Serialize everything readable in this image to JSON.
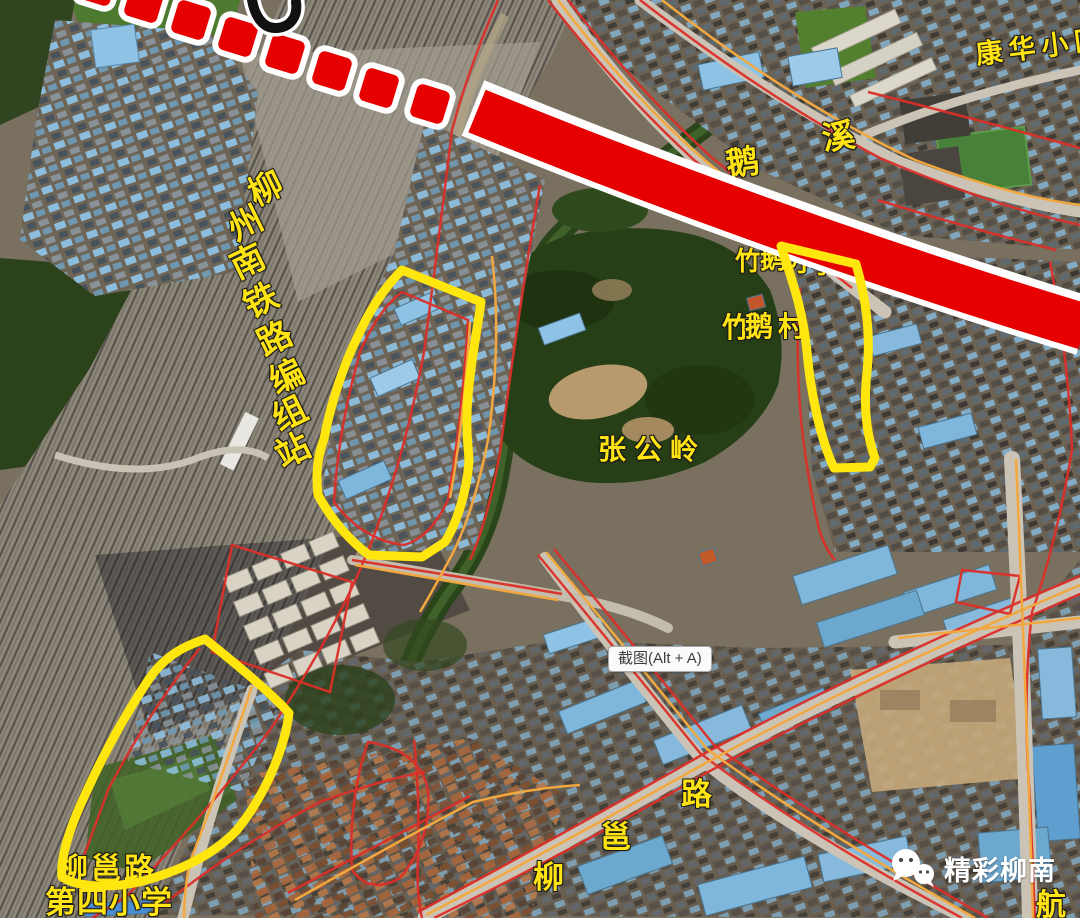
{
  "map": {
    "annotations": {
      "metro_line_color": "#e60000",
      "highlight_color": "#ffe60f",
      "road_line_red": "#dc2f28",
      "road_line_orange": "#f2a83e"
    },
    "labels": {
      "rail_yard": {
        "text": "柳州南铁路编组站",
        "chars": [
          "柳",
          "州",
          "南",
          "铁",
          "路",
          "编",
          "组",
          "站"
        ]
      },
      "goose_creek": {
        "text": "鹅溪",
        "chars": [
          "鹅",
          "溪"
        ]
      },
      "kanghua": {
        "text": "康华小区"
      },
      "zhuge_school": {
        "text": "竹鹅小学",
        "chars": [
          "竹",
          "鹅",
          "小",
          "学"
        ]
      },
      "zhuge_village": {
        "text": "竹鹅村",
        "chars": [
          "竹",
          "鹅",
          "村"
        ]
      },
      "zhanggongling": {
        "text": "张公岭"
      },
      "liuyong_road": {
        "text": "柳邕路",
        "chars": [
          "柳",
          "邕",
          "路"
        ]
      },
      "hang_road": {
        "text": "航"
      },
      "fourth_primary": {
        "line1": "柳邕路",
        "line2": "第四小学"
      }
    },
    "tooltip": {
      "label": "截图(Alt + A)"
    },
    "watermark": {
      "name": "精彩柳南"
    }
  }
}
